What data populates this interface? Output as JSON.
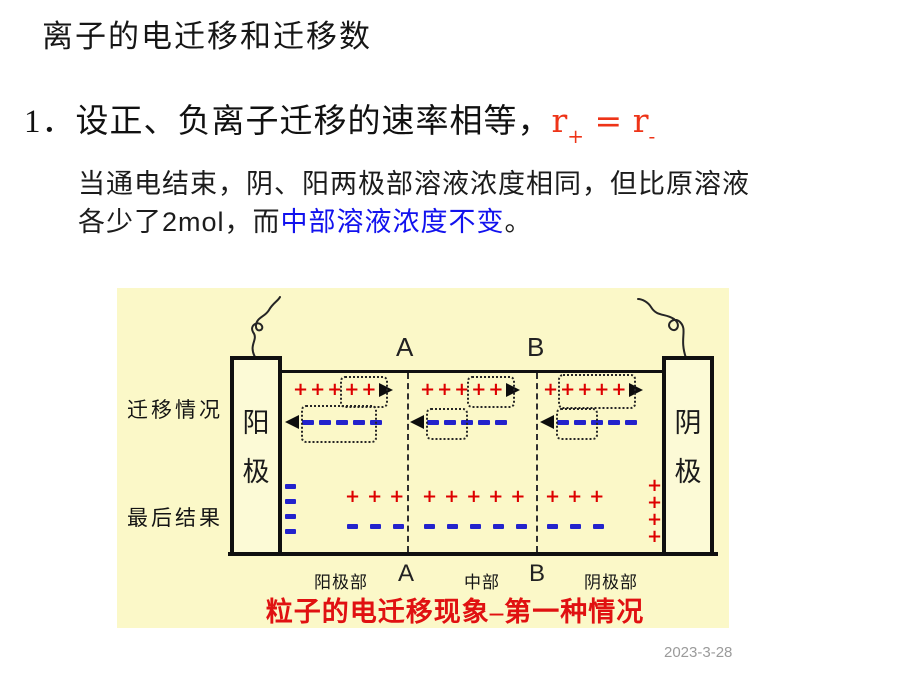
{
  "slide": {
    "title": "离子的电迁移和迁移数",
    "point": {
      "number": "1．",
      "text": "设正、负离子迁移的速率相等，",
      "formula": {
        "lhs": "r",
        "lhs_sub": "+",
        "eq": "=",
        "rhs": "r",
        "rhs_sub": "-"
      }
    },
    "paragraph": {
      "line1": "当通电结束，阴、阳两极部溶液浓度相同，但比原溶液",
      "line2_prefix": "各少了2mol，而",
      "line2_highlight": "中部溶液浓度不变",
      "line2_suffix": "。"
    },
    "date": "2023-3-28"
  },
  "diagram": {
    "caption": "粒子的电迁移现象–第一种情况",
    "row_labels": {
      "migration": "迁移情况",
      "result": "最后结果"
    },
    "electrodes": {
      "left_char1": "阳",
      "left_char2": "极",
      "right_char1": "阴",
      "right_char2": "极"
    },
    "boundaries": {
      "top_a": "A",
      "top_b": "B",
      "bottom_a": "A",
      "bottom_b": "B"
    },
    "regions": {
      "anode": "阳极部",
      "middle": "中部",
      "cathode": "阴极部"
    },
    "symbols": {
      "cation": "+",
      "anion": "-"
    },
    "colors": {
      "background": "#fbf8c8",
      "cation_red": "#dd0000",
      "anion_blue": "#2323cc",
      "caption_red": "#e01111",
      "highlight_blue": "#1212ee",
      "formula_red": "#ee3418"
    },
    "migration_row": {
      "sections": [
        {
          "name": "anode-region",
          "cations": 5,
          "cations_boxed": "last 2",
          "anions": 5,
          "anions_boxed": "first 4"
        },
        {
          "name": "middle-region",
          "cations": 5,
          "cations_boxed": "last 2",
          "anions": 5,
          "anions_boxed": "first 2"
        },
        {
          "name": "cathode-region",
          "cations": 5,
          "cations_boxed": "last 4",
          "anions": 5,
          "anions_boxed": "first 2"
        }
      ]
    },
    "result_row": {
      "anode_surface_anions": 4,
      "regions": [
        {
          "name": "anode-region",
          "cations": 3,
          "anions": 3
        },
        {
          "name": "middle-region",
          "cations": 5,
          "anions": 5
        },
        {
          "name": "cathode-region",
          "cations": 3,
          "anions": 3
        }
      ],
      "cathode_surface_cations": 4
    }
  }
}
